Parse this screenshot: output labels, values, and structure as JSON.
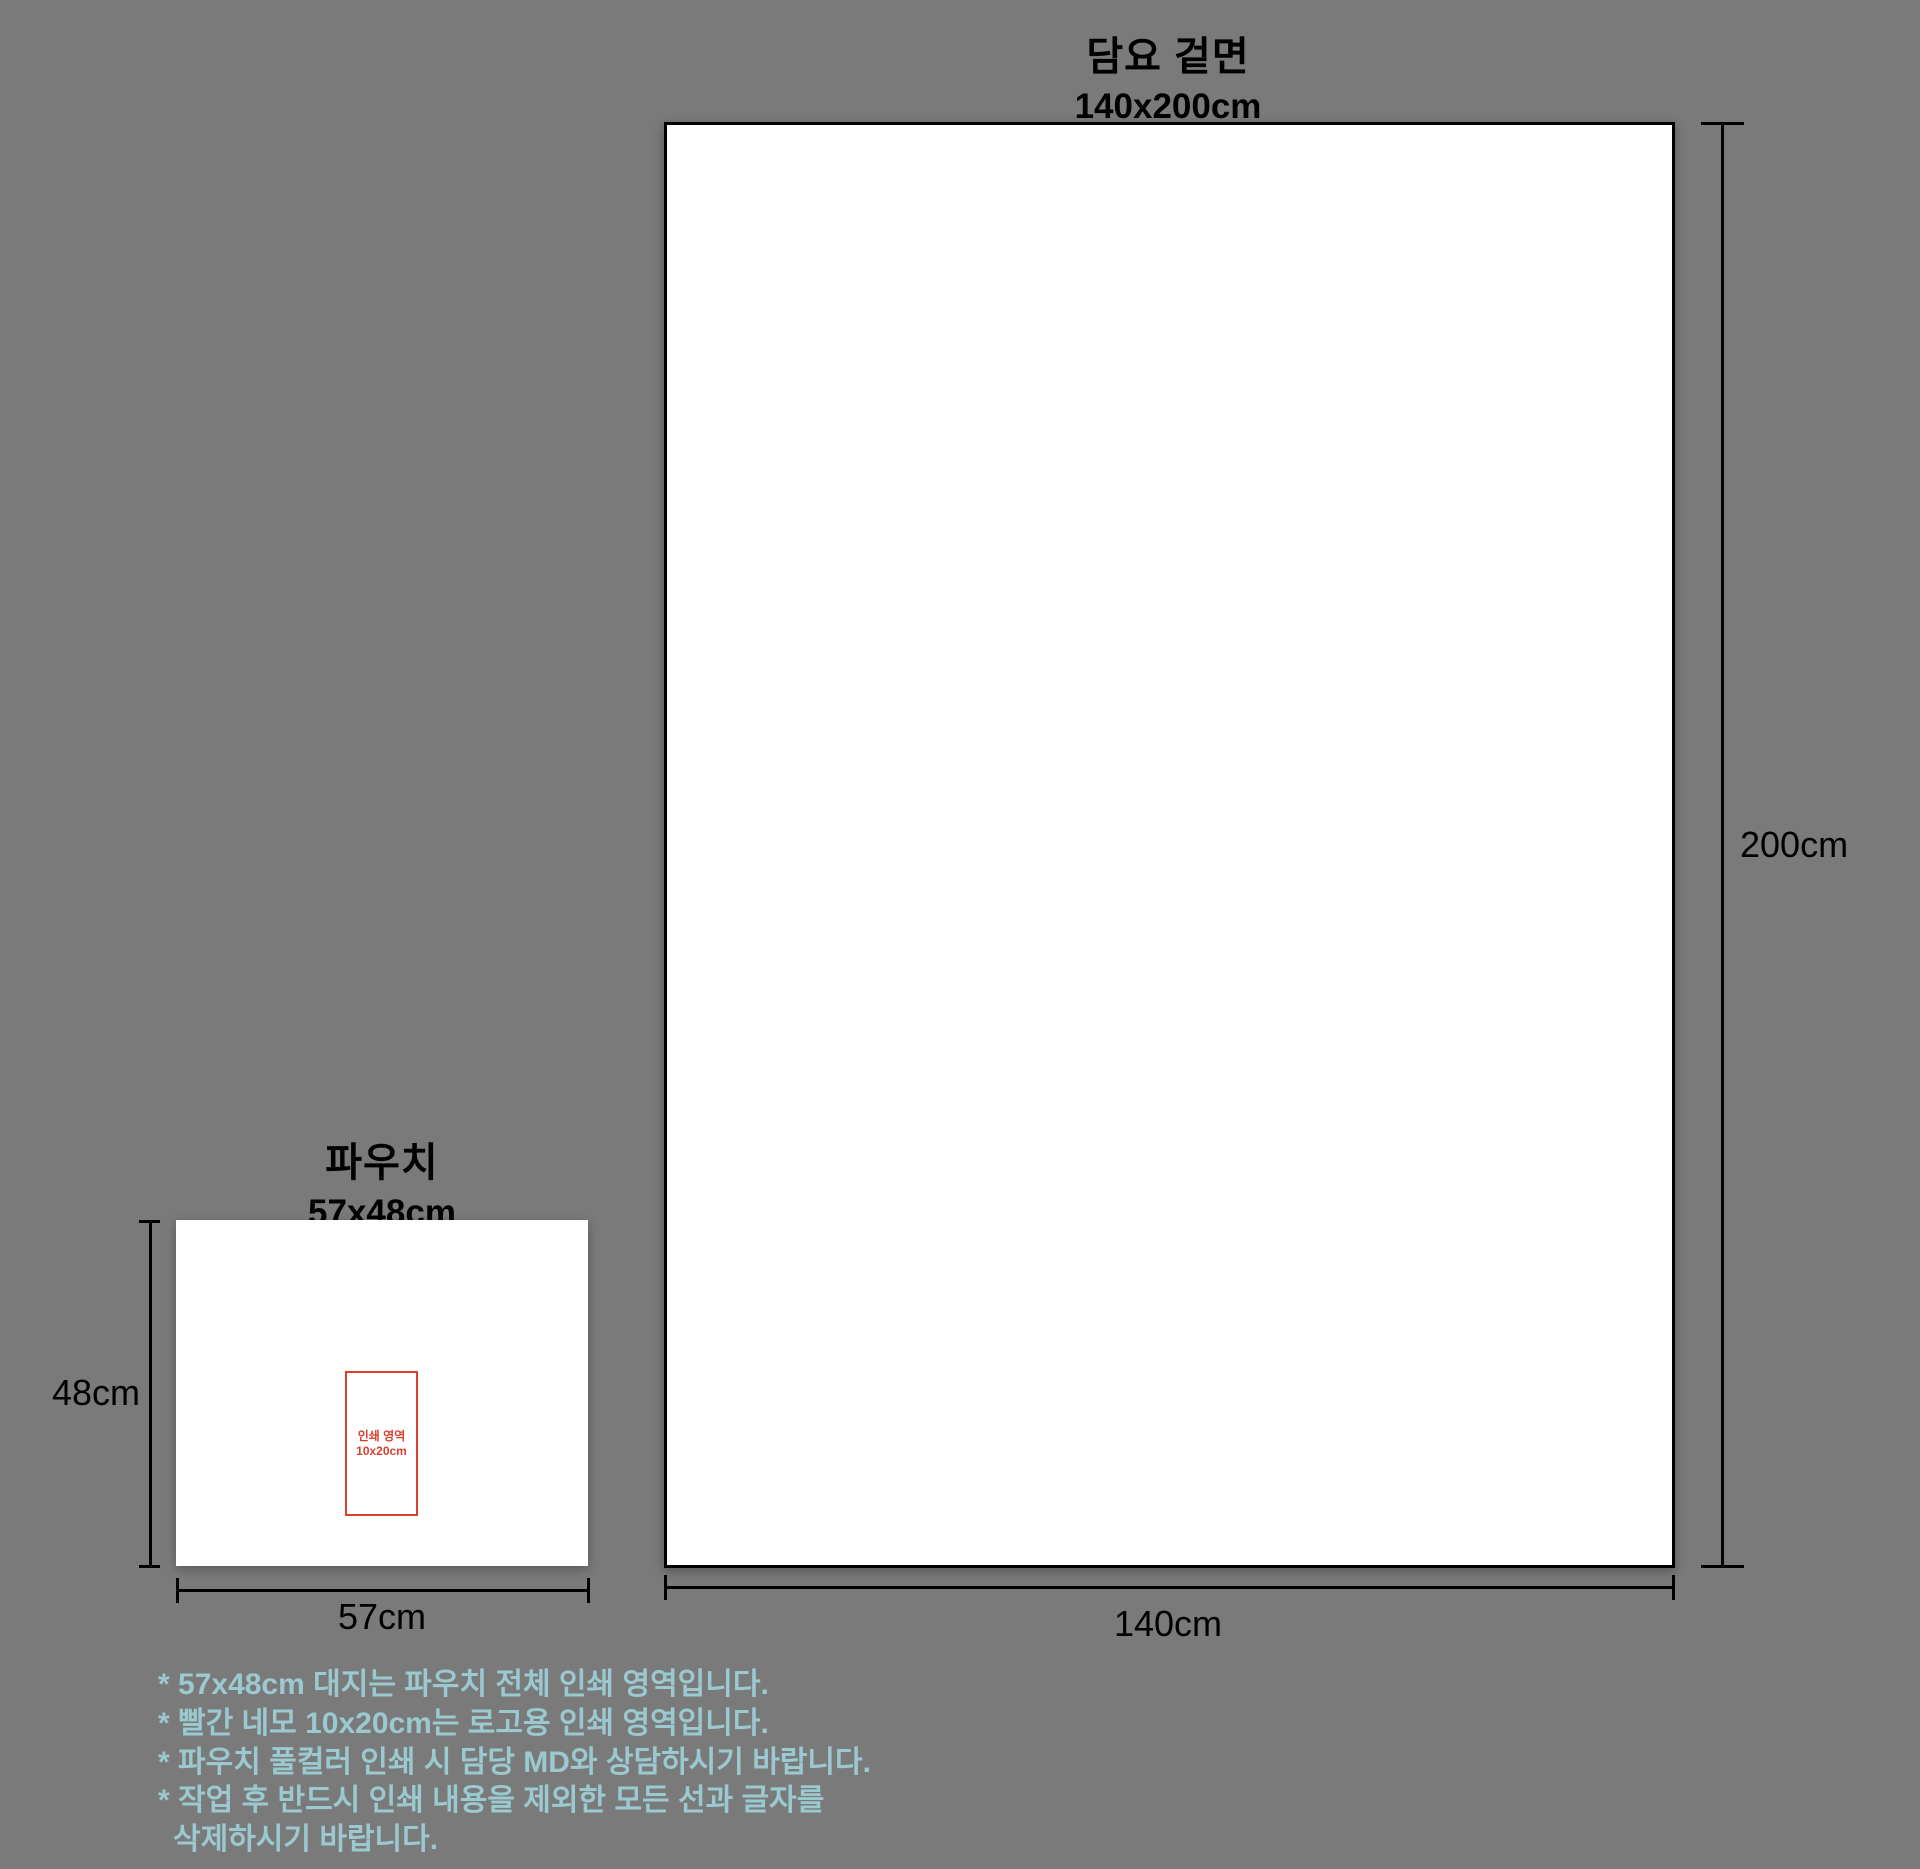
{
  "colors": {
    "background": "#7a7a7a",
    "artboard_fill": "#ffffff",
    "outline_black": "#000000",
    "print_area_red": "#d9412f",
    "notes_blue": "#9bc9d0"
  },
  "blanket": {
    "title": "담요 겉면",
    "size_label": "140x200cm",
    "height_label": "200cm",
    "width_label": "140cm"
  },
  "pouch": {
    "title": "파우치",
    "size_label": "57x48cm",
    "height_label": "48cm",
    "width_label": "57cm",
    "print_area": {
      "label_line1": "인쇄 영역",
      "label_line2": "10x20cm"
    }
  },
  "notes": {
    "lines": [
      "* 57x48cm 대지는 파우치 전체 인쇄 영역입니다.",
      "* 빨간 네모 10x20cm는 로고용 인쇄 영역입니다.",
      "* 파우치 풀컬러 인쇄 시 담당 MD와 상담하시기 바랍니다.",
      "* 작업 후 반드시 인쇄 내용을 제외한 모든 선과 글자를",
      "삭제하시기 바랍니다."
    ]
  }
}
